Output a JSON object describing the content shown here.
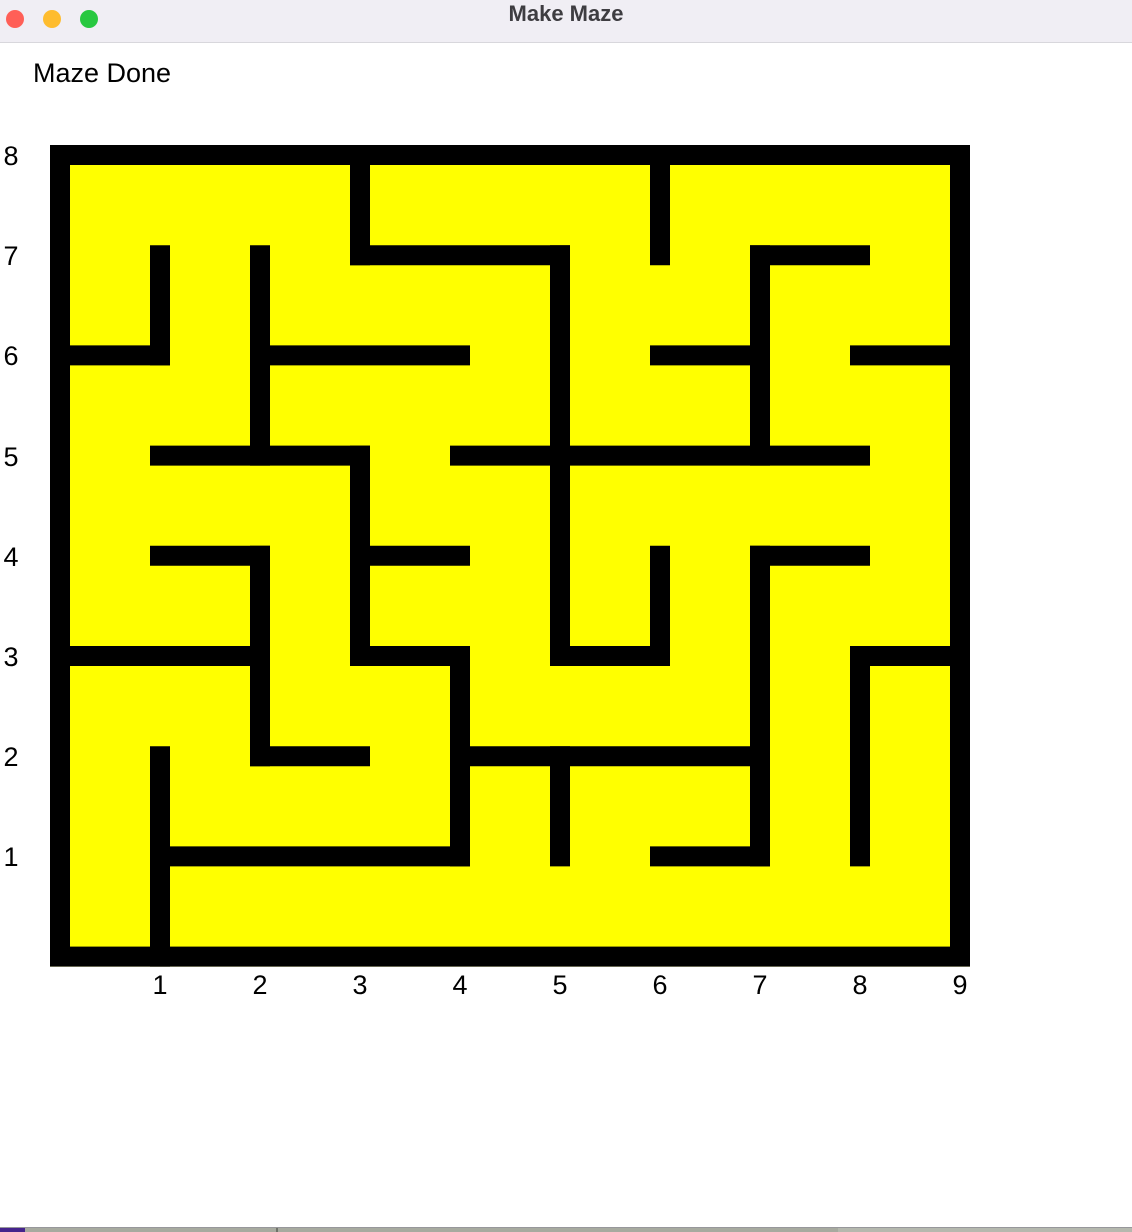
{
  "window": {
    "title": "Make Maze",
    "titlebar_bg": "#f0eef4",
    "title_color": "#3e3d41",
    "traffic_lights": {
      "close": "#ff5f57",
      "minimize": "#febc2e",
      "zoom": "#28c840"
    }
  },
  "status_text": "Maze Done",
  "maze": {
    "bg_color": "#ffff00",
    "wall_color": "#000000",
    "label_color": "#000000",
    "cols": 9,
    "rows": 8,
    "origin_x": 60,
    "origin_y": 155,
    "pitch_x": 100,
    "pitch_y": 100.2,
    "wall_thickness": 20,
    "h_walls": [
      {
        "y": 1,
        "x1": 3,
        "x2": 5
      },
      {
        "y": 1,
        "x1": 7,
        "x2": 8
      },
      {
        "y": 2,
        "x1": 0,
        "x2": 1
      },
      {
        "y": 2,
        "x1": 2,
        "x2": 4
      },
      {
        "y": 2,
        "x1": 6,
        "x2": 7
      },
      {
        "y": 2,
        "x1": 8,
        "x2": 9
      },
      {
        "y": 3,
        "x1": 1,
        "x2": 3
      },
      {
        "y": 3,
        "x1": 4,
        "x2": 8
      },
      {
        "y": 4,
        "x1": 1,
        "x2": 2
      },
      {
        "y": 4,
        "x1": 3,
        "x2": 4
      },
      {
        "y": 4,
        "x1": 7,
        "x2": 8
      },
      {
        "y": 5,
        "x1": 0,
        "x2": 2
      },
      {
        "y": 5,
        "x1": 3,
        "x2": 4
      },
      {
        "y": 5,
        "x1": 5,
        "x2": 6
      },
      {
        "y": 5,
        "x1": 8,
        "x2": 9
      },
      {
        "y": 6,
        "x1": 2,
        "x2": 3
      },
      {
        "y": 6,
        "x1": 4,
        "x2": 7
      },
      {
        "y": 7,
        "x1": 1,
        "x2": 4
      },
      {
        "y": 7,
        "x1": 6,
        "x2": 7
      }
    ],
    "v_walls": [
      {
        "x": 1,
        "y1": 1,
        "y2": 2
      },
      {
        "x": 1,
        "y1": 6,
        "y2": 8
      },
      {
        "x": 2,
        "y1": 1,
        "y2": 3
      },
      {
        "x": 2,
        "y1": 4,
        "y2": 6
      },
      {
        "x": 3,
        "y1": 0,
        "y2": 1
      },
      {
        "x": 3,
        "y1": 3,
        "y2": 5
      },
      {
        "x": 4,
        "y1": 5,
        "y2": 7
      },
      {
        "x": 5,
        "y1": 1,
        "y2": 5
      },
      {
        "x": 5,
        "y1": 6,
        "y2": 7
      },
      {
        "x": 6,
        "y1": 0,
        "y2": 1
      },
      {
        "x": 6,
        "y1": 4,
        "y2": 5
      },
      {
        "x": 7,
        "y1": 1,
        "y2": 3
      },
      {
        "x": 7,
        "y1": 4,
        "y2": 7
      },
      {
        "x": 8,
        "y1": 5,
        "y2": 7
      }
    ],
    "x_labels": [
      "1",
      "2",
      "3",
      "4",
      "5",
      "6",
      "7",
      "8",
      "9"
    ],
    "y_labels": [
      "8",
      "7",
      "6",
      "5",
      "4",
      "3",
      "2",
      "1"
    ]
  },
  "scrollbar": {
    "accent_color": "#45238c",
    "track_color": "#a7aa9f",
    "track_color_light": "#b5b8ae",
    "divider_color": "#6f7269",
    "accent_width": 25,
    "divider_x": 276,
    "light_from_x": 838
  }
}
